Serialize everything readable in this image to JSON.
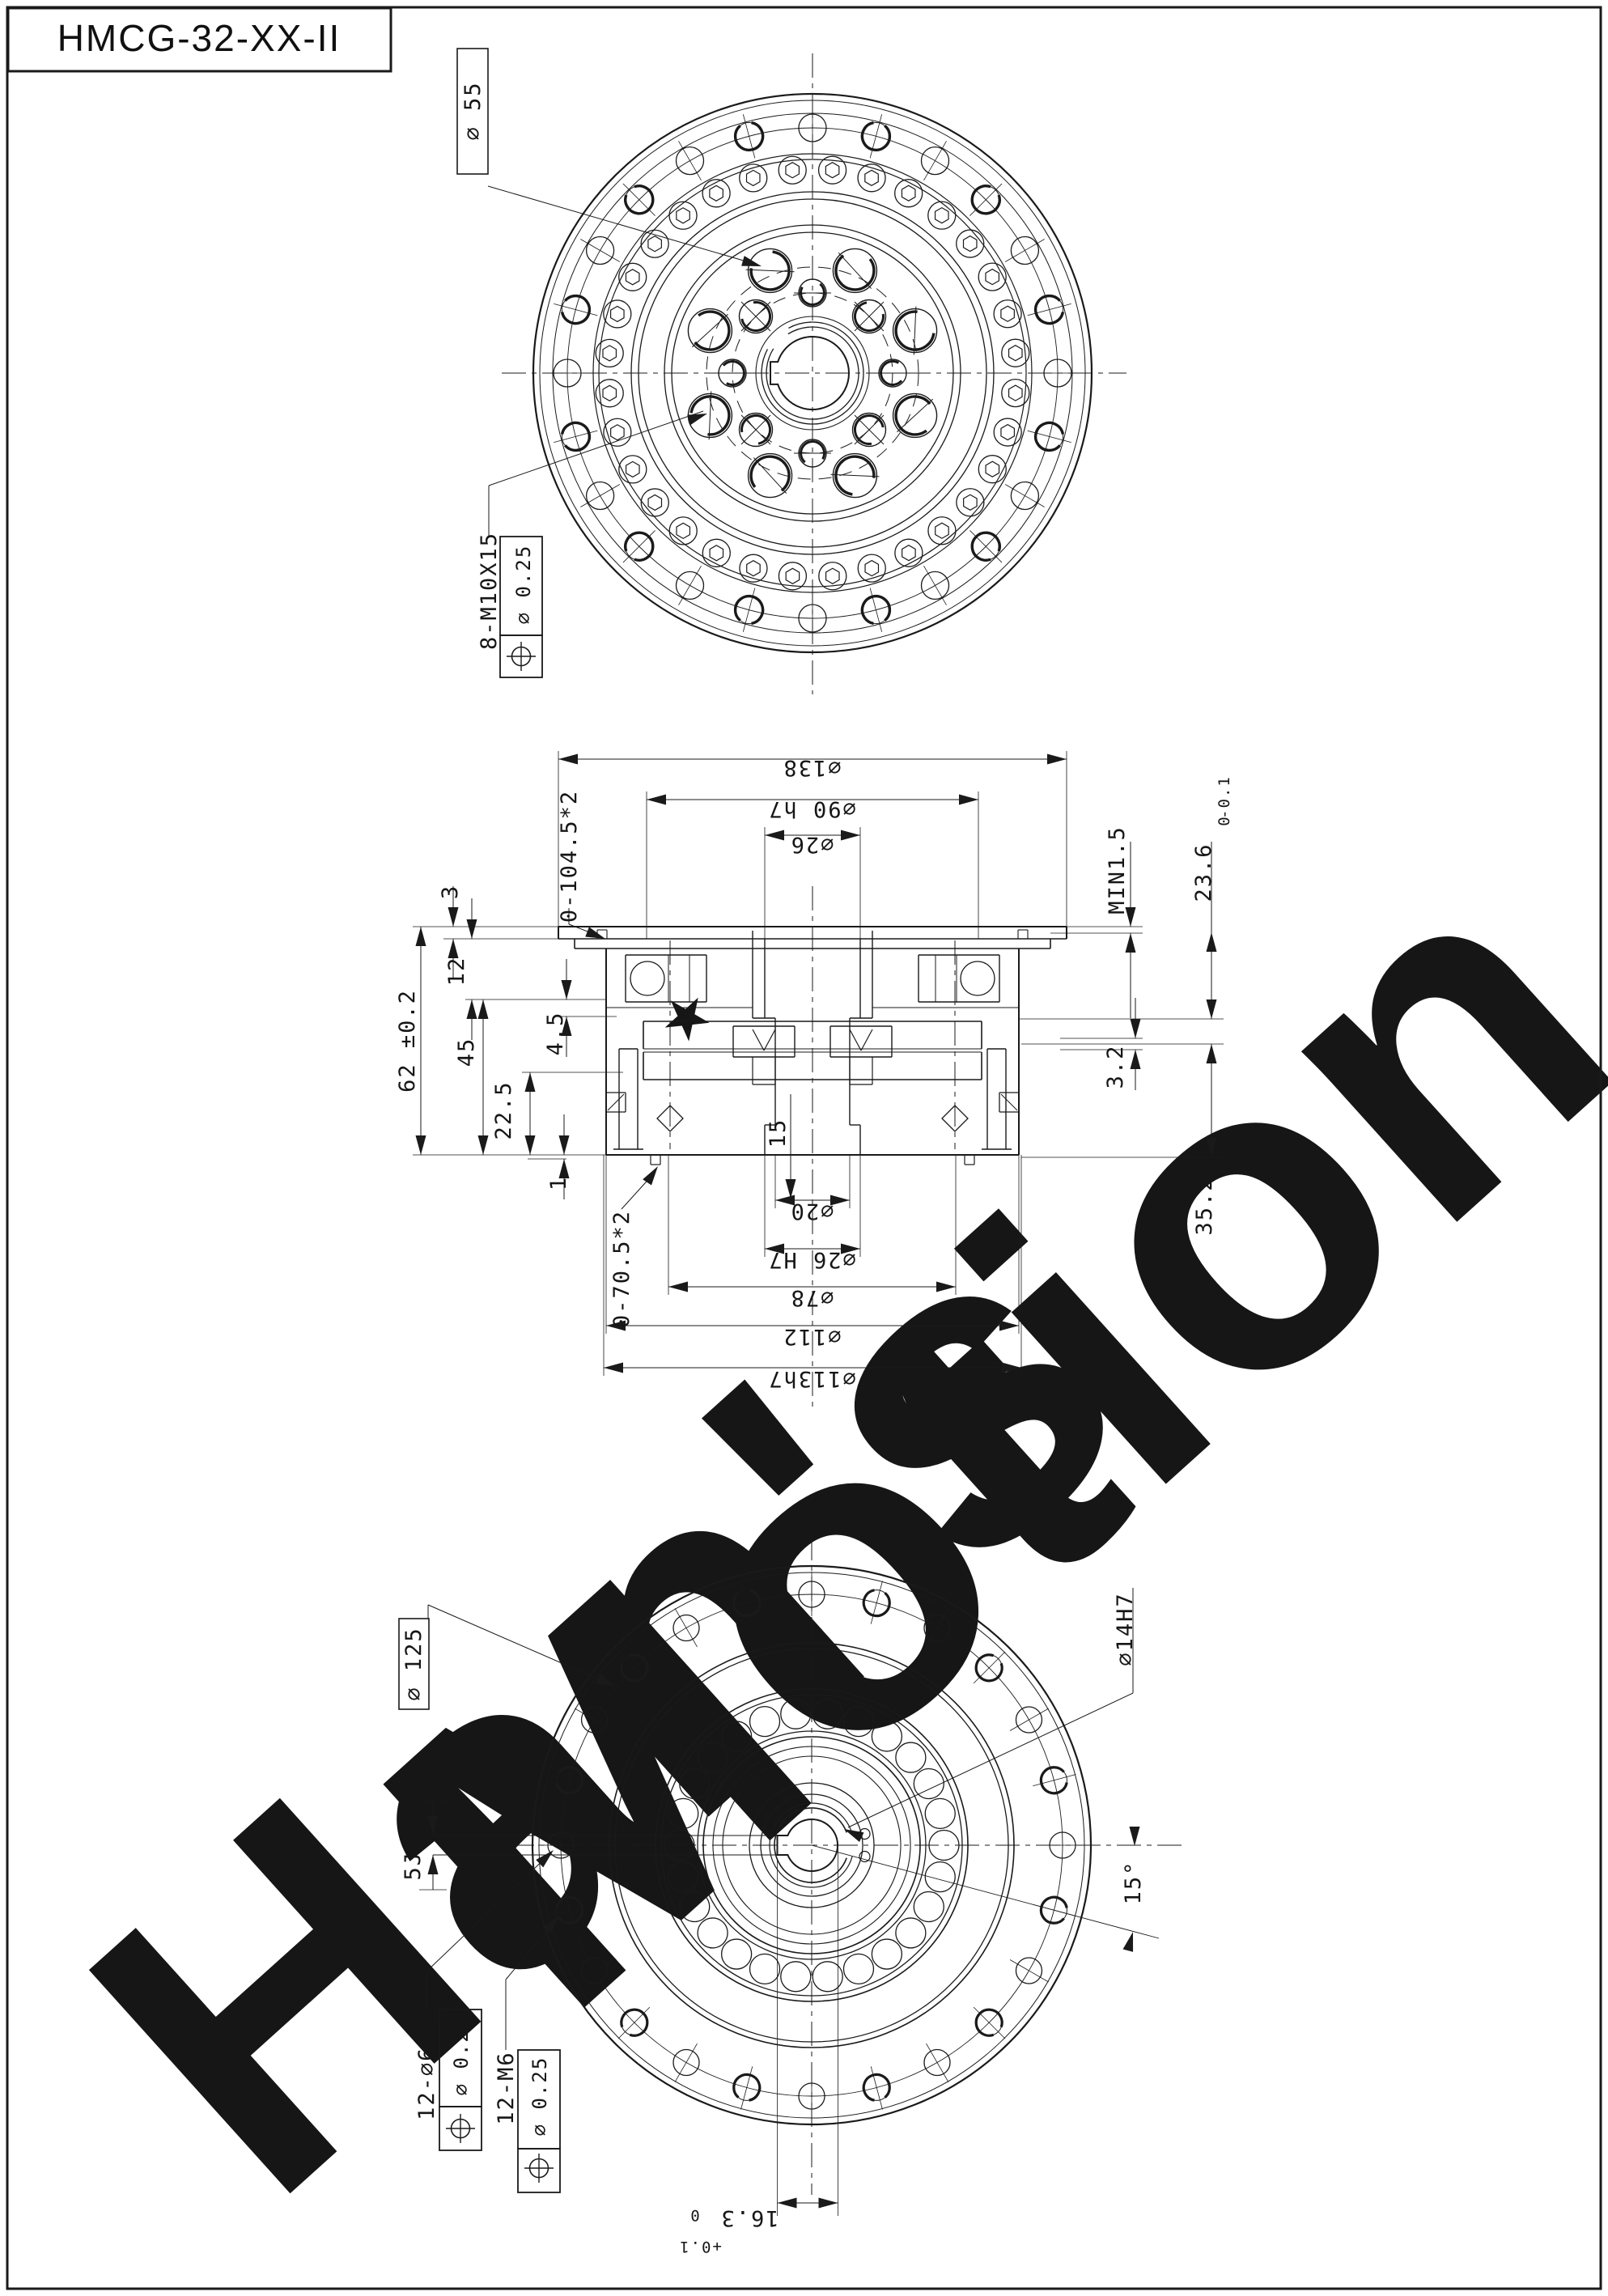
{
  "title": "HMCG-32-XX-II",
  "watermark": {
    "word1": "Han's",
    "word2": "Motion",
    "star": "★",
    "brand_blue": "#d9e6f4",
    "brand_gray": "#dad7d3",
    "brand_warm_gray": "#d6d0c8"
  },
  "top_view": {
    "bolt_circle_label": "∅ 55",
    "tapped_holes_label": "8-M10X15",
    "position_tolerance": "∅ 0.25"
  },
  "section_view": {
    "dia_flange": "∅138",
    "dia_spigot": "∅90 h7",
    "dia_input_bore": "∅26",
    "oring_top": "0-104.5*2",
    "min_clearance": "MIN1.5",
    "depth_236": "23.6",
    "depth_236_tol_upper": "0",
    "depth_236_tol_lower": "-0.1",
    "thk_3": "3",
    "thk_12": "12",
    "height_62": "62 ±0.2",
    "height_45": "45",
    "height_225": "22.5",
    "height_45s": "4.5",
    "height_1": "1",
    "depth_15": "15",
    "height_32": "3.2",
    "height_352": "35.2",
    "oring_bottom": "0-70.5*2",
    "dia_20": "∅20",
    "dia_26h7": "∅26 H7",
    "dia_78": "∅78",
    "dia_112": "∅112",
    "dia_113": "∅113h7"
  },
  "bottom_view": {
    "bolt_circle_label": "∅ 125",
    "center_bore": "∅14H7",
    "key_width": "5JS9",
    "hole_angle": "15°",
    "clearance_holes": "12-∅6.6",
    "tapped_holes": "12-M6",
    "position_tolerance": "∅ 0.25",
    "key_depth": "16.3",
    "key_depth_tol_upper": "+0.1",
    "key_depth_tol_lower": "0"
  }
}
